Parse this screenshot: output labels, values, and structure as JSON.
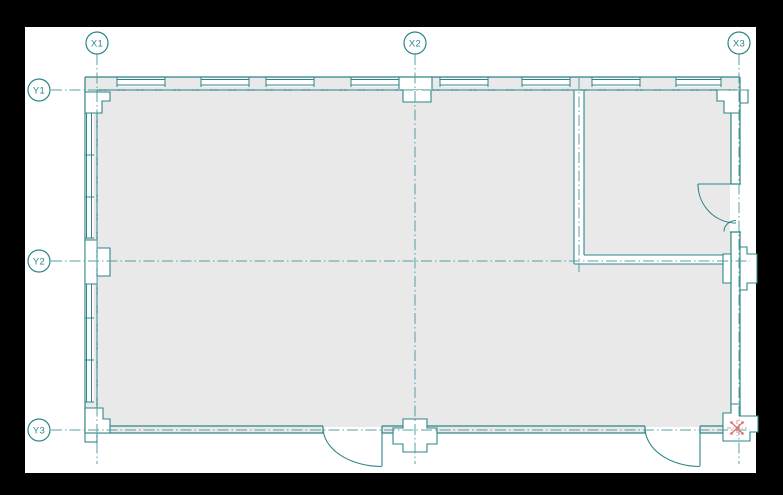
{
  "page": {
    "background_color": "#000000",
    "paper_color": "#ffffff"
  },
  "drawing": {
    "colors": {
      "wall_line": "#2e8589",
      "grid_line": "#57a0a3",
      "floor_fill": "#e9e9e9",
      "marker_red": "#e87272"
    },
    "grid_axes": {
      "x": [
        {
          "label": "X1"
        },
        {
          "label": "X2"
        },
        {
          "label": "X3"
        }
      ],
      "y": [
        {
          "label": "Y1"
        },
        {
          "label": "Y2"
        },
        {
          "label": "Y3"
        }
      ]
    }
  }
}
